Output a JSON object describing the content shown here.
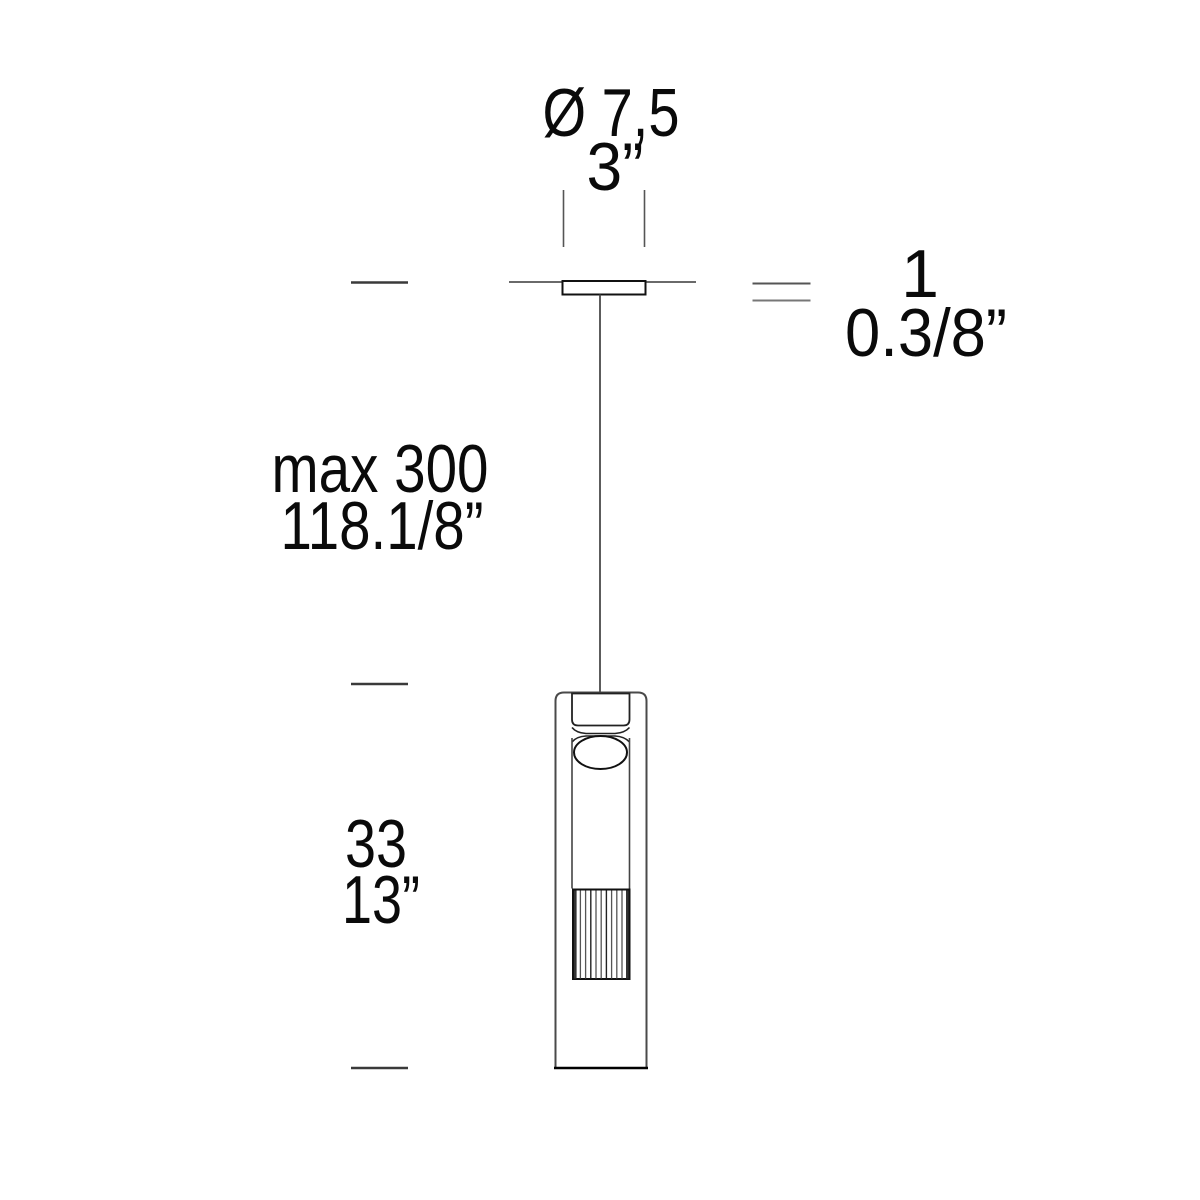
{
  "diagram": {
    "dimensions": {
      "canopy_diameter": {
        "metric": "Ø 7,5",
        "imperial": "3”"
      },
      "canopy_height": {
        "metric": "1",
        "imperial": "0.3/8”"
      },
      "suspension_length": {
        "metric": "max 300",
        "imperial": "118.1/8”"
      },
      "fixture_height": {
        "metric": "33",
        "imperial": "13”"
      }
    }
  }
}
